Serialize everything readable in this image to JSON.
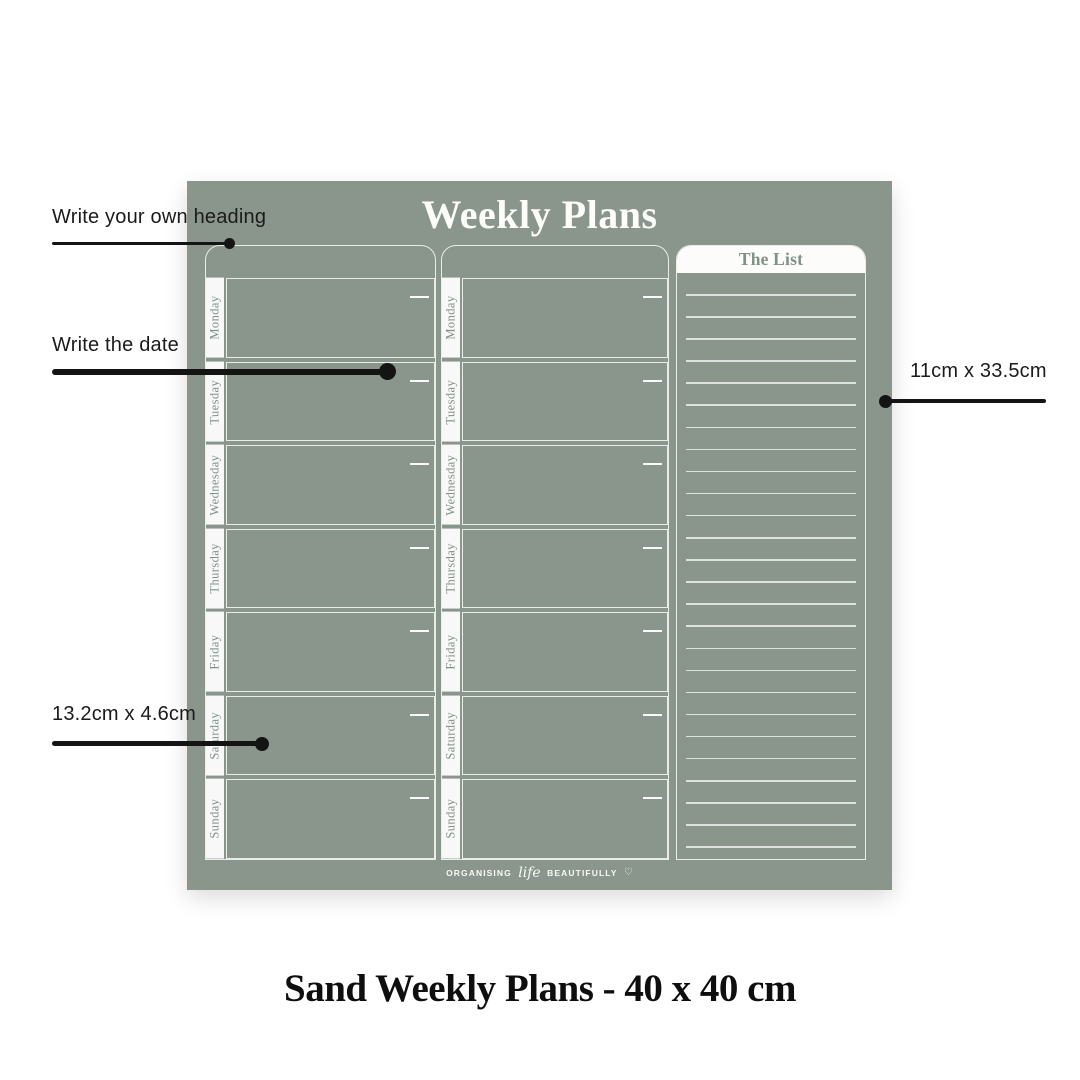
{
  "board": {
    "title": "Weekly Plans",
    "days": [
      "Monday",
      "Tuesday",
      "Wednesday",
      "Thursday",
      "Friday",
      "Saturday",
      "Sunday"
    ],
    "week_column_count": 2,
    "list": {
      "title": "The List",
      "line_count": 26
    },
    "logo": {
      "pre": "ORGANISING",
      "script": "life",
      "post": "BEAUTIFULLY",
      "heart": "♡"
    },
    "colors": {
      "board_green": "#8a968c",
      "text_green": "#7f9187",
      "line_white": "rgba(255,255,255,0.82)",
      "annotation_ink": "#1b1b1b"
    }
  },
  "annotations": [
    {
      "label": "Write your own heading"
    },
    {
      "label": "Write the date"
    },
    {
      "label": "13.2cm x 4.6cm"
    },
    {
      "label": "11cm x 33.5cm"
    }
  ],
  "caption": "Sand Weekly Plans - 40 x 40 cm"
}
